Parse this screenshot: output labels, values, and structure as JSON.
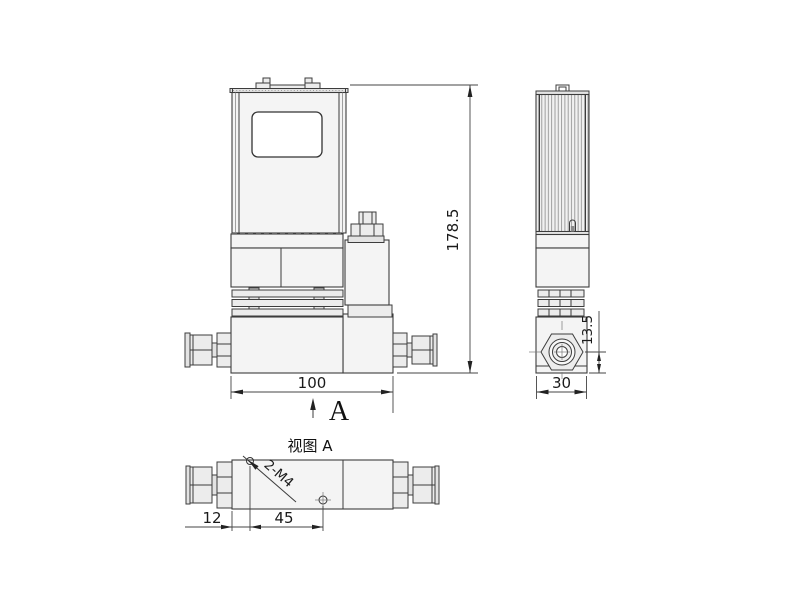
{
  "drawing": {
    "dimensions": {
      "overall_height": "178.5",
      "overall_width": "100",
      "depth": "30",
      "port_center_to_base": "13.5",
      "hole_edge_offset": "12",
      "hole_spacing": "45",
      "thread_callout": "2-M4"
    },
    "labels": {
      "view_direction": "A",
      "view_a_title": "视图 A"
    },
    "colors": {
      "line": "#3c3c3c",
      "fill_light": "#f4f4f4",
      "background": "#ffffff"
    }
  }
}
